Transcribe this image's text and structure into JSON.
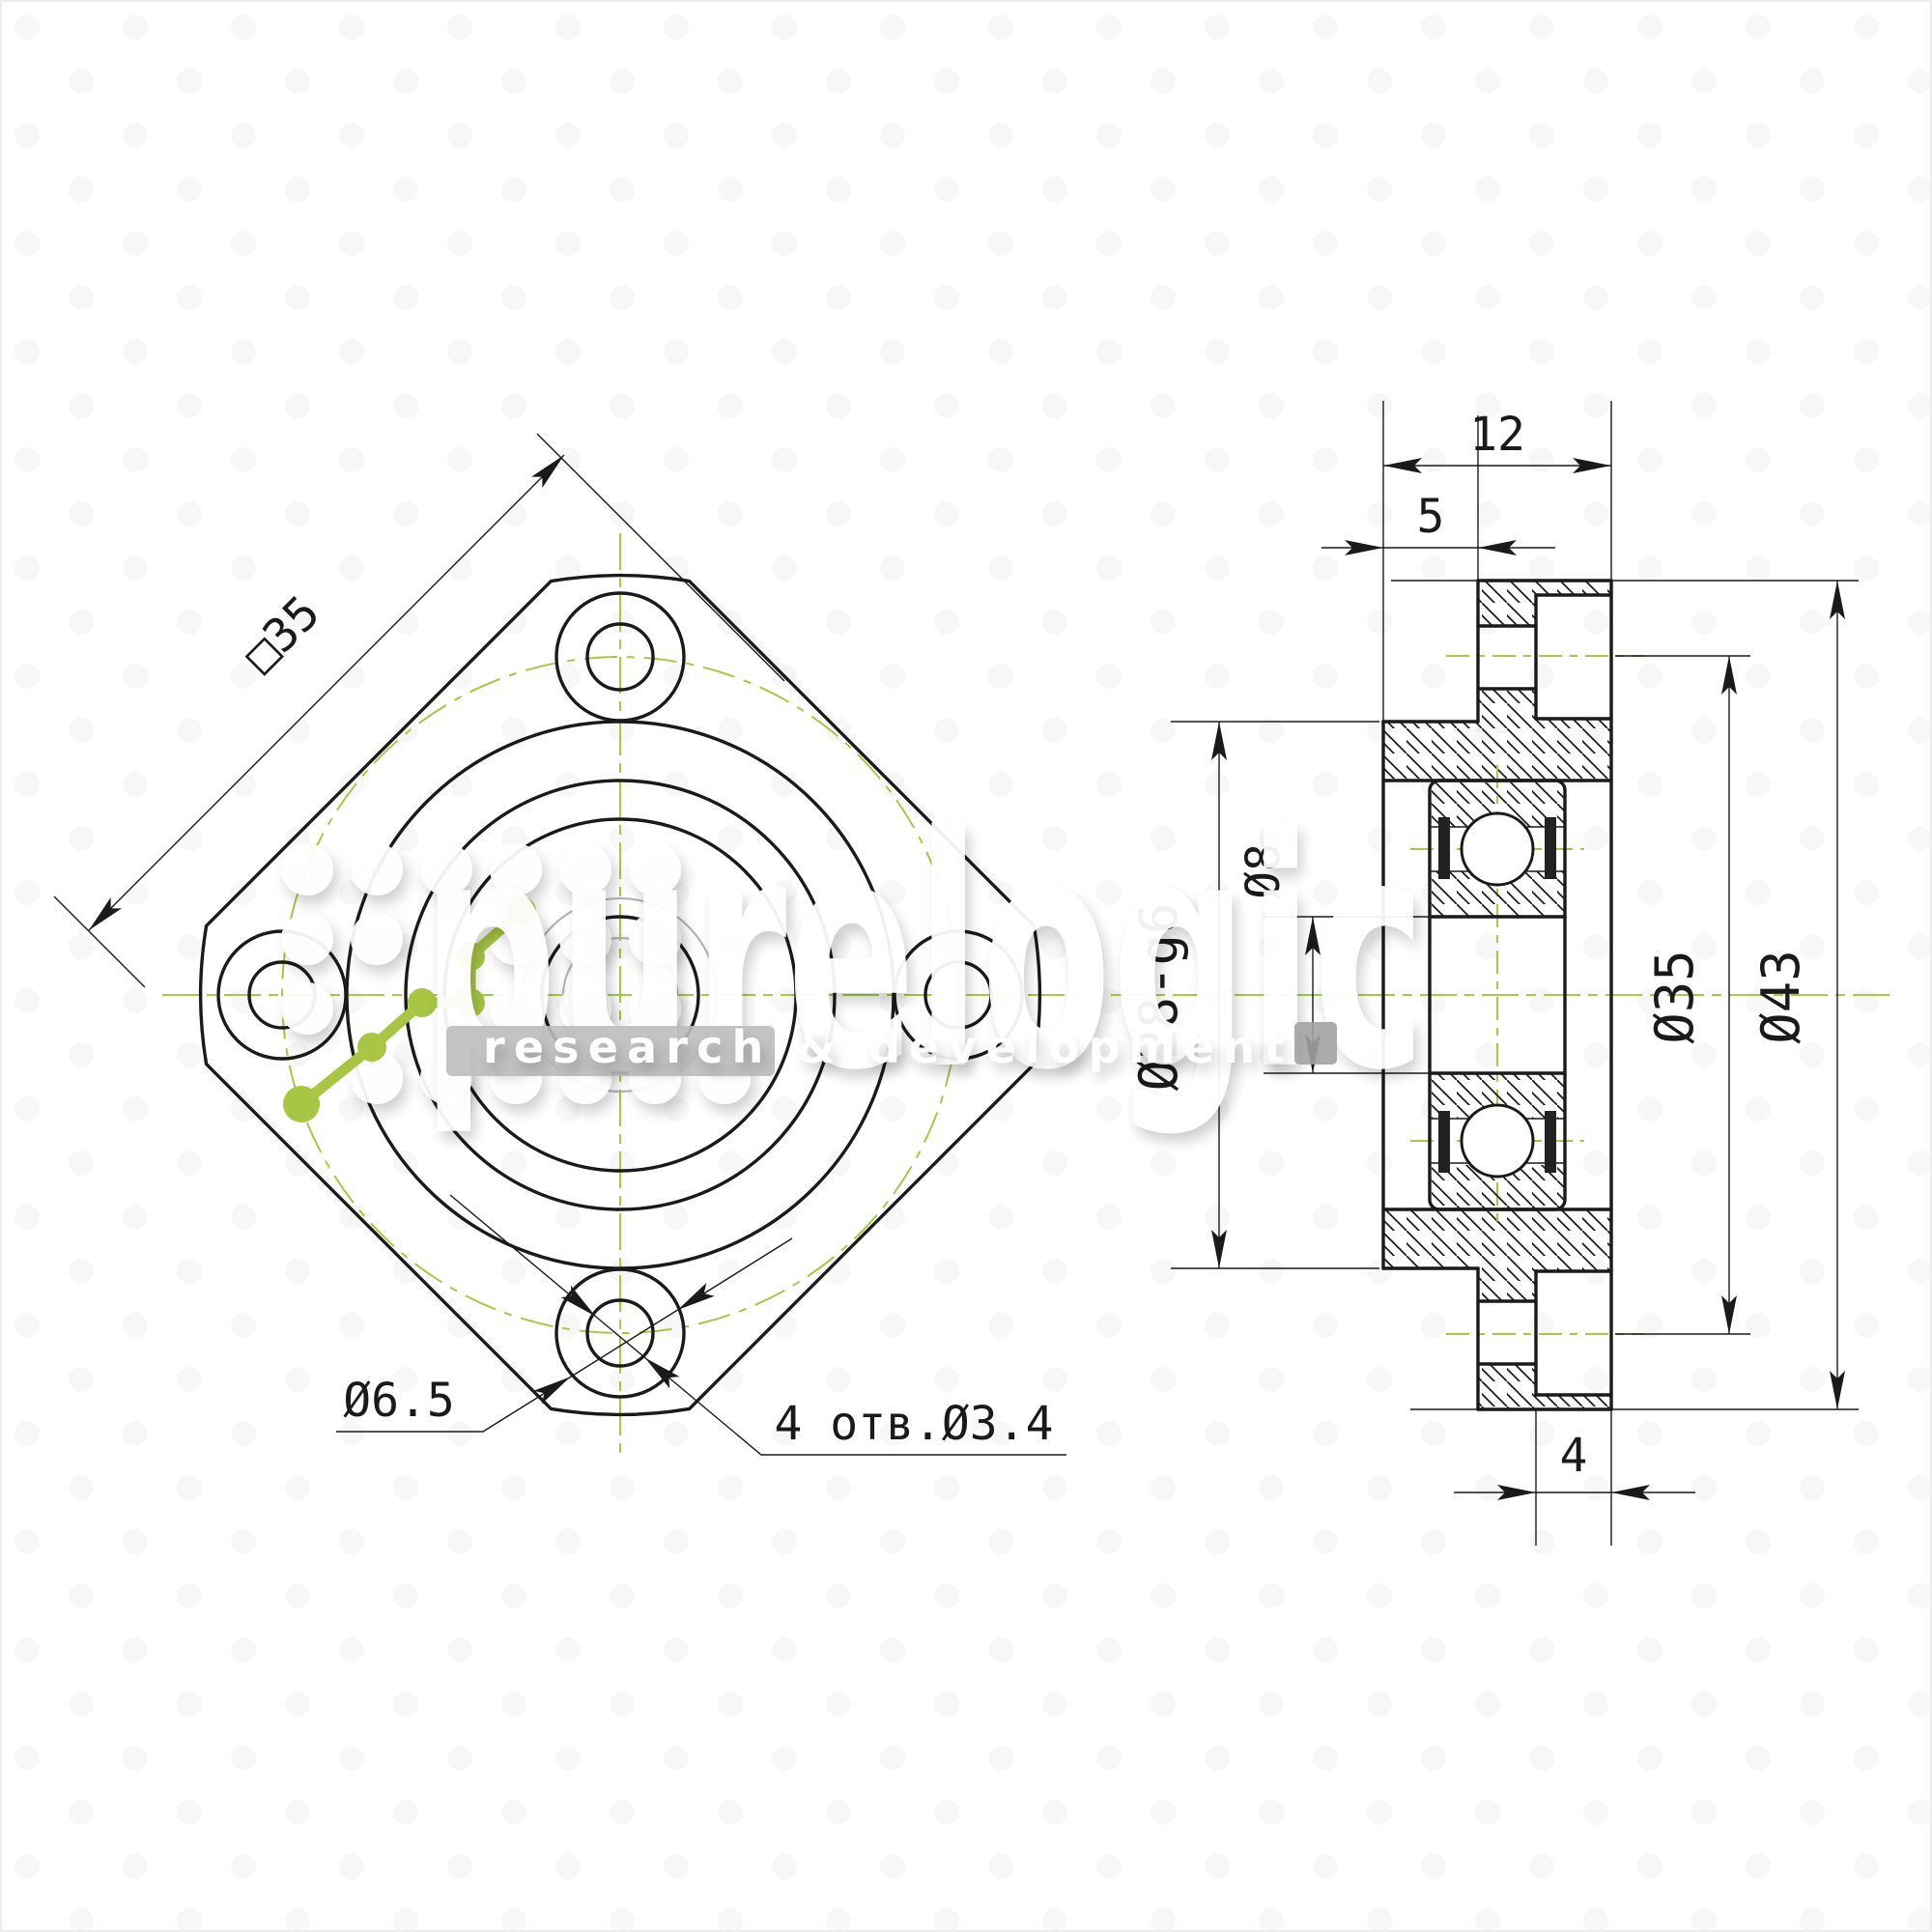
{
  "front_view": {
    "square_size_label": "□35",
    "counterbore_dia_label": "Ø6.5",
    "bolt_holes_label": "4 отв.Ø3.4"
  },
  "side_view": {
    "total_width_label": "12",
    "boss_protrusion_label": "5",
    "bore_dia_label": "Ø8",
    "boss_dia_label": "Ø28-g6",
    "bolt_circle_dia_label": "Ø35",
    "flange_dia_label": "Ø43",
    "counterbore_depth_label": "4"
  },
  "watermark": {
    "brand": "purelogic",
    "tagline": "research & development"
  },
  "colors": {
    "line": "#1a1a1a",
    "centerline_green": "#a5c944",
    "logo_green": "#a8c544",
    "ghost_gray": "#b4b4b4",
    "watermark_gray": "#bcbcbc"
  }
}
